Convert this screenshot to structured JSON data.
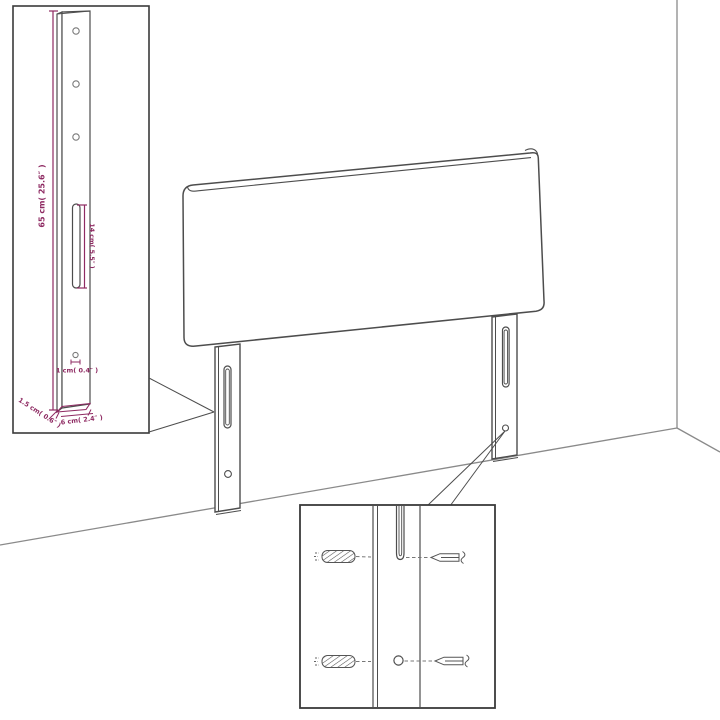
{
  "diagram": {
    "title": "headboard-assembly-diagram",
    "subject": "Upholstered headboard with two mounting legs shown against a room corner, with a magnified leg detail inset and a magnified wall-fixing (screw and wall plug) detail inset",
    "colors": {
      "background": "#ffffff",
      "line_art": "#4d4d4d",
      "room_lines": "#8a8a8a",
      "dimension_accent": "#8e2a62"
    },
    "dimensions": {
      "leg_height": "65 cm( 25.6″ )",
      "slot_length": "14 cm( 5.5″ )",
      "hole_diameter": "1 cm( 0.4″ )",
      "leg_thickness": "1.5 cm( 0.6″ )",
      "leg_width": "6 cm( 2.4″ )"
    },
    "insets": {
      "leg_detail": "magnified left mounting leg with three holes, keyhole slot and bottom hole",
      "fixing_detail": "magnified leg section with two wall plugs and two screws aligned to slot and hole"
    }
  }
}
